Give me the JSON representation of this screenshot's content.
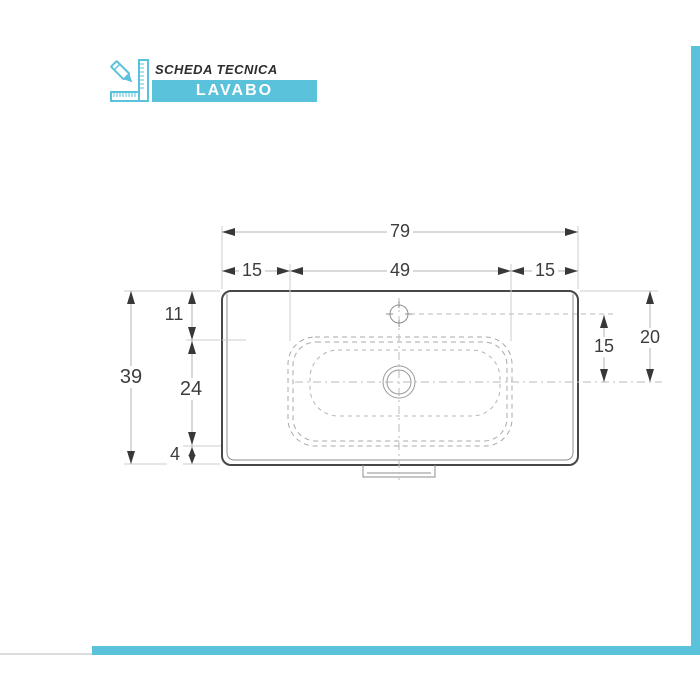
{
  "header": {
    "icon": "pencil-ruler-icon",
    "title": "SCHEDA TECNICA",
    "banner": "LAVABO"
  },
  "colors": {
    "accent_teal": "#5bc2dc",
    "outline_dark": "#474747",
    "dimension_line": "#b3b3b3",
    "dashed_line": "#a9a9a9",
    "text": "#3d3d3d"
  },
  "drawing": {
    "type": "technical-drawing-top-view",
    "dimensions": {
      "total_width": "79",
      "left_section": "15",
      "basin_width": "49",
      "right_section": "15",
      "total_depth": "39",
      "back_to_basin": "11",
      "basin_depth": "24",
      "basin_to_front": "4",
      "tap_to_drain": "15",
      "back_to_drain": "20"
    }
  }
}
